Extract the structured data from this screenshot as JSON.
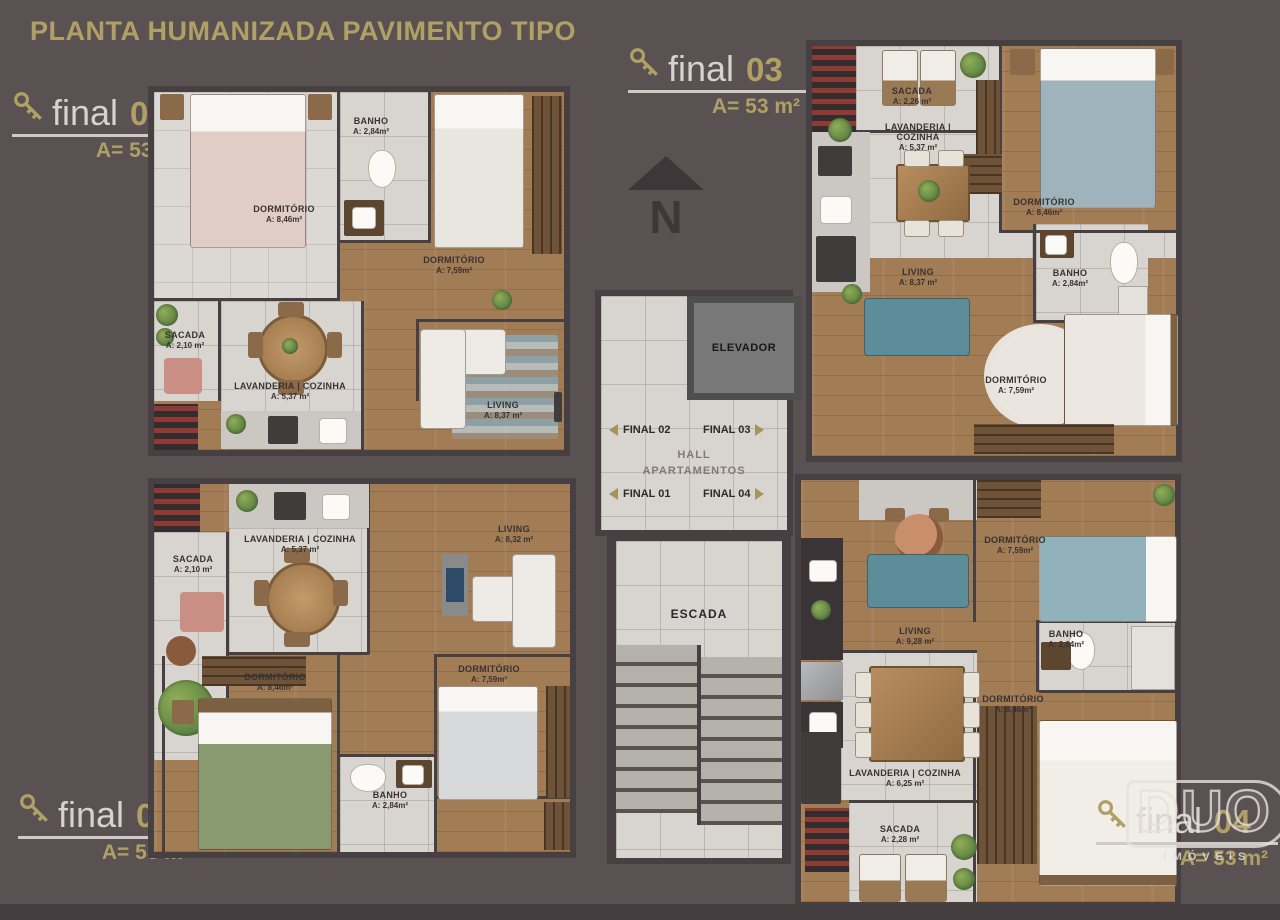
{
  "page": {
    "title": "PLANTA HUMANIZADA PAVIMENTO TIPO"
  },
  "colors": {
    "accent": "#b1a065",
    "background": "#5a5152",
    "wall": "#464042",
    "wood": "#a17c55",
    "tile": "#d8d5d0",
    "sofa_teal": "#5d8d99",
    "rug_blue": "#8aa3ad",
    "bed_green": "#8a9a70"
  },
  "units": [
    {
      "label": "final",
      "number": "01",
      "area": "A= 53 m²",
      "rooms": [
        {
          "name": "DORMITÓRIO",
          "area": "A: 8,46m²"
        },
        {
          "name": "BANHO",
          "area": "A: 2,84m²"
        },
        {
          "name": "DORMITÓRIO",
          "area": "A: 7,59m²"
        },
        {
          "name": "SACADA",
          "area": "A: 2,10 m²"
        },
        {
          "name": "LAVANDERIA | COZINHA",
          "area": "A: 5,37 m²"
        },
        {
          "name": "LIVING",
          "area": "A: 8,37 m²"
        }
      ]
    },
    {
      "label": "final",
      "number": "02",
      "area": "A= 53 m²",
      "rooms": [
        {
          "name": "SACADA",
          "area": "A: 2,10 m²"
        },
        {
          "name": "LAVANDERIA | COZINHA",
          "area": "A: 5,37 m²"
        },
        {
          "name": "LIVING",
          "area": "A: 8,32 m²"
        },
        {
          "name": "DORMITÓRIO",
          "area": "A: 8,46m²"
        },
        {
          "name": "DORMITÓRIO",
          "area": "A: 7,59m²"
        },
        {
          "name": "BANHO",
          "area": "A: 2,84m²"
        }
      ]
    },
    {
      "label": "final",
      "number": "03",
      "area": "A= 53 m²",
      "rooms": [
        {
          "name": "SACADA",
          "area": "A: 2,26 m²"
        },
        {
          "name": "LAVANDERIA | COZINHA",
          "area": "A: 5,37 m²"
        },
        {
          "name": "DORMITÓRIO",
          "area": "A: 8,46m²"
        },
        {
          "name": "BANHO",
          "area": "A: 2,84m²"
        },
        {
          "name": "LIVING",
          "area": "A: 8,37 m²"
        },
        {
          "name": "DORMITÓRIO",
          "area": "A: 7,59m²"
        }
      ]
    },
    {
      "label": "final",
      "number": "04",
      "area": "A= 53 m²",
      "rooms": [
        {
          "name": "DORMITÓRIO",
          "area": "A: 7,59m²"
        },
        {
          "name": "LIVING",
          "area": "A: 9,28 m²"
        },
        {
          "name": "BANHO",
          "area": "A: 2,64m²"
        },
        {
          "name": "DORMITÓRIO",
          "area": "A: 8,46m²"
        },
        {
          "name": "LAVANDERIA | COZINHA",
          "area": "A: 6,25 m²"
        },
        {
          "name": "SACADA",
          "area": "A: 2,28 m²"
        }
      ]
    }
  ],
  "core": {
    "elevator": "ELEVADOR",
    "hall_line1": "HALL",
    "hall_line2": "APARTAMENTOS",
    "stairs": "ESCADA",
    "signs": [
      {
        "label": "FINAL 02",
        "dir": "left"
      },
      {
        "label": "FINAL 03",
        "dir": "right"
      },
      {
        "label": "FINAL 01",
        "dir": "left"
      },
      {
        "label": "FINAL 04",
        "dir": "right"
      }
    ]
  },
  "compass": {
    "letter": "N"
  },
  "logo": {
    "name": "DUO",
    "subtitle": "IMÓVEIS"
  }
}
